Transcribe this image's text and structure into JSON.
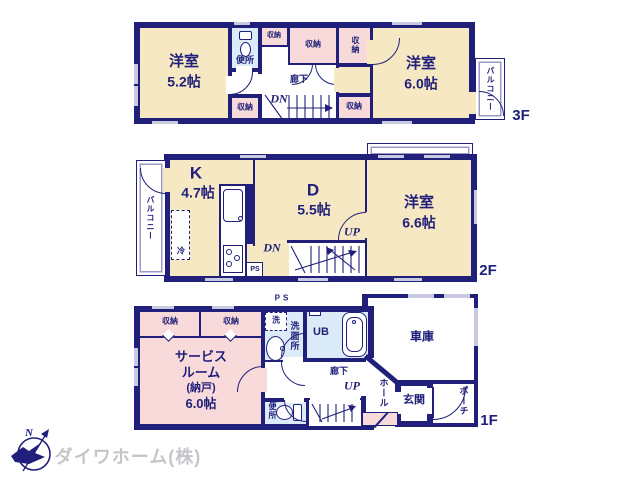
{
  "palette": {
    "navy": "#20207a",
    "cream": "#f7e8c4",
    "pink": "#f9dada",
    "blue": "#dcebf8",
    "win": "#c9c9e2",
    "logo_gray": "#c6c6ca"
  },
  "labels": {
    "storage": "収納",
    "toilet": "便所",
    "hallway": "廊下",
    "dn": "DN",
    "up": "UP",
    "balcony": "バルコニー",
    "ps": "PS",
    "fridge": "冷",
    "washer": "洗",
    "washroom": "洗面所",
    "unit_bath": "UB",
    "garage": "車庫",
    "hall": "ホール",
    "entrance": "玄関",
    "porch": "ポーチ"
  },
  "floors": {
    "f3": {
      "tag": "3F",
      "room_west": {
        "name": "洋室",
        "size": "5.2帖"
      },
      "room_east": {
        "name": "洋室",
        "size": "6.0帖"
      }
    },
    "f2": {
      "tag": "2F",
      "kitchen": {
        "name": "K",
        "size": "4.7帖"
      },
      "dining": {
        "name": "D",
        "size": "5.5帖"
      },
      "room_east": {
        "name": "洋室",
        "size": "6.6帖"
      }
    },
    "f1": {
      "tag": "1F",
      "service": {
        "line1": "サービス",
        "line2": "ルーム",
        "line3": "(納戸)",
        "line4": "6.0帖"
      }
    }
  },
  "logo": {
    "company": "ダイワホーム(株)",
    "compass_n": "N"
  }
}
